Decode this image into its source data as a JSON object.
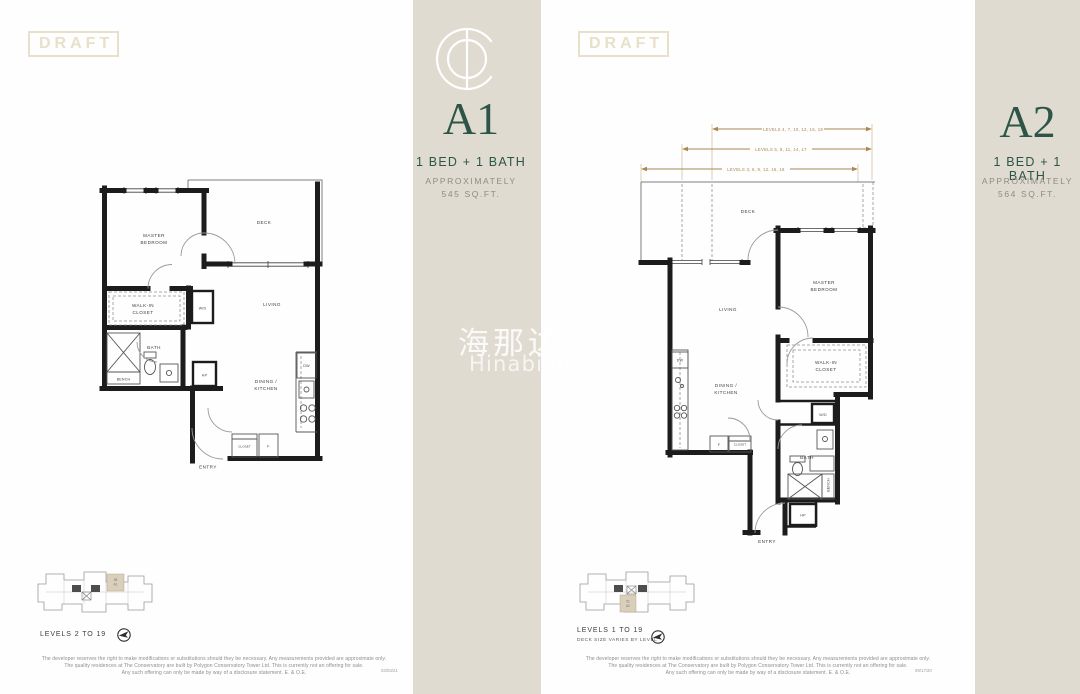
{
  "page": {
    "watermark_cjk": "海那边",
    "watermark_latin": "Hinabian"
  },
  "colors": {
    "accent_green": "#2d5547",
    "panel_beige": "#e0dbd0",
    "draft_beige": "#e8e0ca",
    "dimension_tan": "#ab8752",
    "keyplan_highlight": "#d9cfba"
  },
  "plans": [
    {
      "draft": "DRAFT",
      "code": "A1",
      "type": "1 BED + 1 BATH",
      "approx_label": "APPROXIMATELY",
      "area": "545 SQ.FT.",
      "rooms": {
        "master1": "MASTER",
        "master2": "BEDROOM",
        "deck": "DECK",
        "living": "LIVING",
        "walkin1": "WALK-IN",
        "walkin2": "CLOSET",
        "wd": "W/D",
        "bath": "BATH",
        "bench": "BENCH",
        "hp": "HP",
        "dining1": "DINING /",
        "dining2": "KITCHEN",
        "dw": "DW",
        "closet": "CLOSET",
        "fridge": "F",
        "entry": "ENTRY"
      },
      "keyplan": {
        "unit": "08",
        "plan": "A1",
        "levels": "LEVELS 2 TO 19",
        "note": ""
      },
      "disclaimer": {
        "line1": "The developer reserves the right to make modifications or substitutions should they be necessary. Any measurements provided are approximate only.",
        "line2": "The quality residences at The Conservatory are built by Polygon Conservatory Tower Ltd. This is currently not an offering for sale.",
        "line3": "Any such offering can only be made by way of a disclosure statement. E. & O.E.",
        "date": "03/03/21"
      }
    },
    {
      "draft": "DRAFT",
      "code": "A2",
      "type": "1 BED + 1 BATH",
      "approx_label": "APPROXIMATELY",
      "area": "564 SQ.FT.",
      "dims": [
        "LEVELS 4, 7, 10, 13, 16, 19",
        "LEVELS 5, 8, 11, 14, 17",
        "LEVELS 3, 6, 9, 12, 15, 18"
      ],
      "rooms": {
        "master1": "MASTER",
        "master2": "BEDROOM",
        "deck": "DECK",
        "living": "LIVING",
        "walkin1": "WALK-IN",
        "walkin2": "CLOSET",
        "wd": "W/D",
        "bath": "BATH",
        "bench": "BENCH",
        "hp": "HP",
        "dining1": "DINING /",
        "dining2": "KITCHEN",
        "dw": "DW",
        "closet": "CLOSET",
        "fridge": "F",
        "entry": "ENTRY"
      },
      "keyplan": {
        "unit": "01",
        "plan": "A2",
        "levels": "LEVELS 1 TO 19",
        "note": "DECK SIZE VARIES BY LEVEL"
      },
      "disclaimer": {
        "line1": "The developer reserves the right to make modifications or substitutions should they be necessary. Any measurements provided are approximate only.",
        "line2": "The quality residences at The Conservatory are built by Polygon Conservatory Tower Ltd. This is currently not an offering for sale.",
        "line3": "Any such offering can only be made by way of a disclosure statement. E. & O.E.",
        "date": "09/17/20"
      }
    }
  ]
}
